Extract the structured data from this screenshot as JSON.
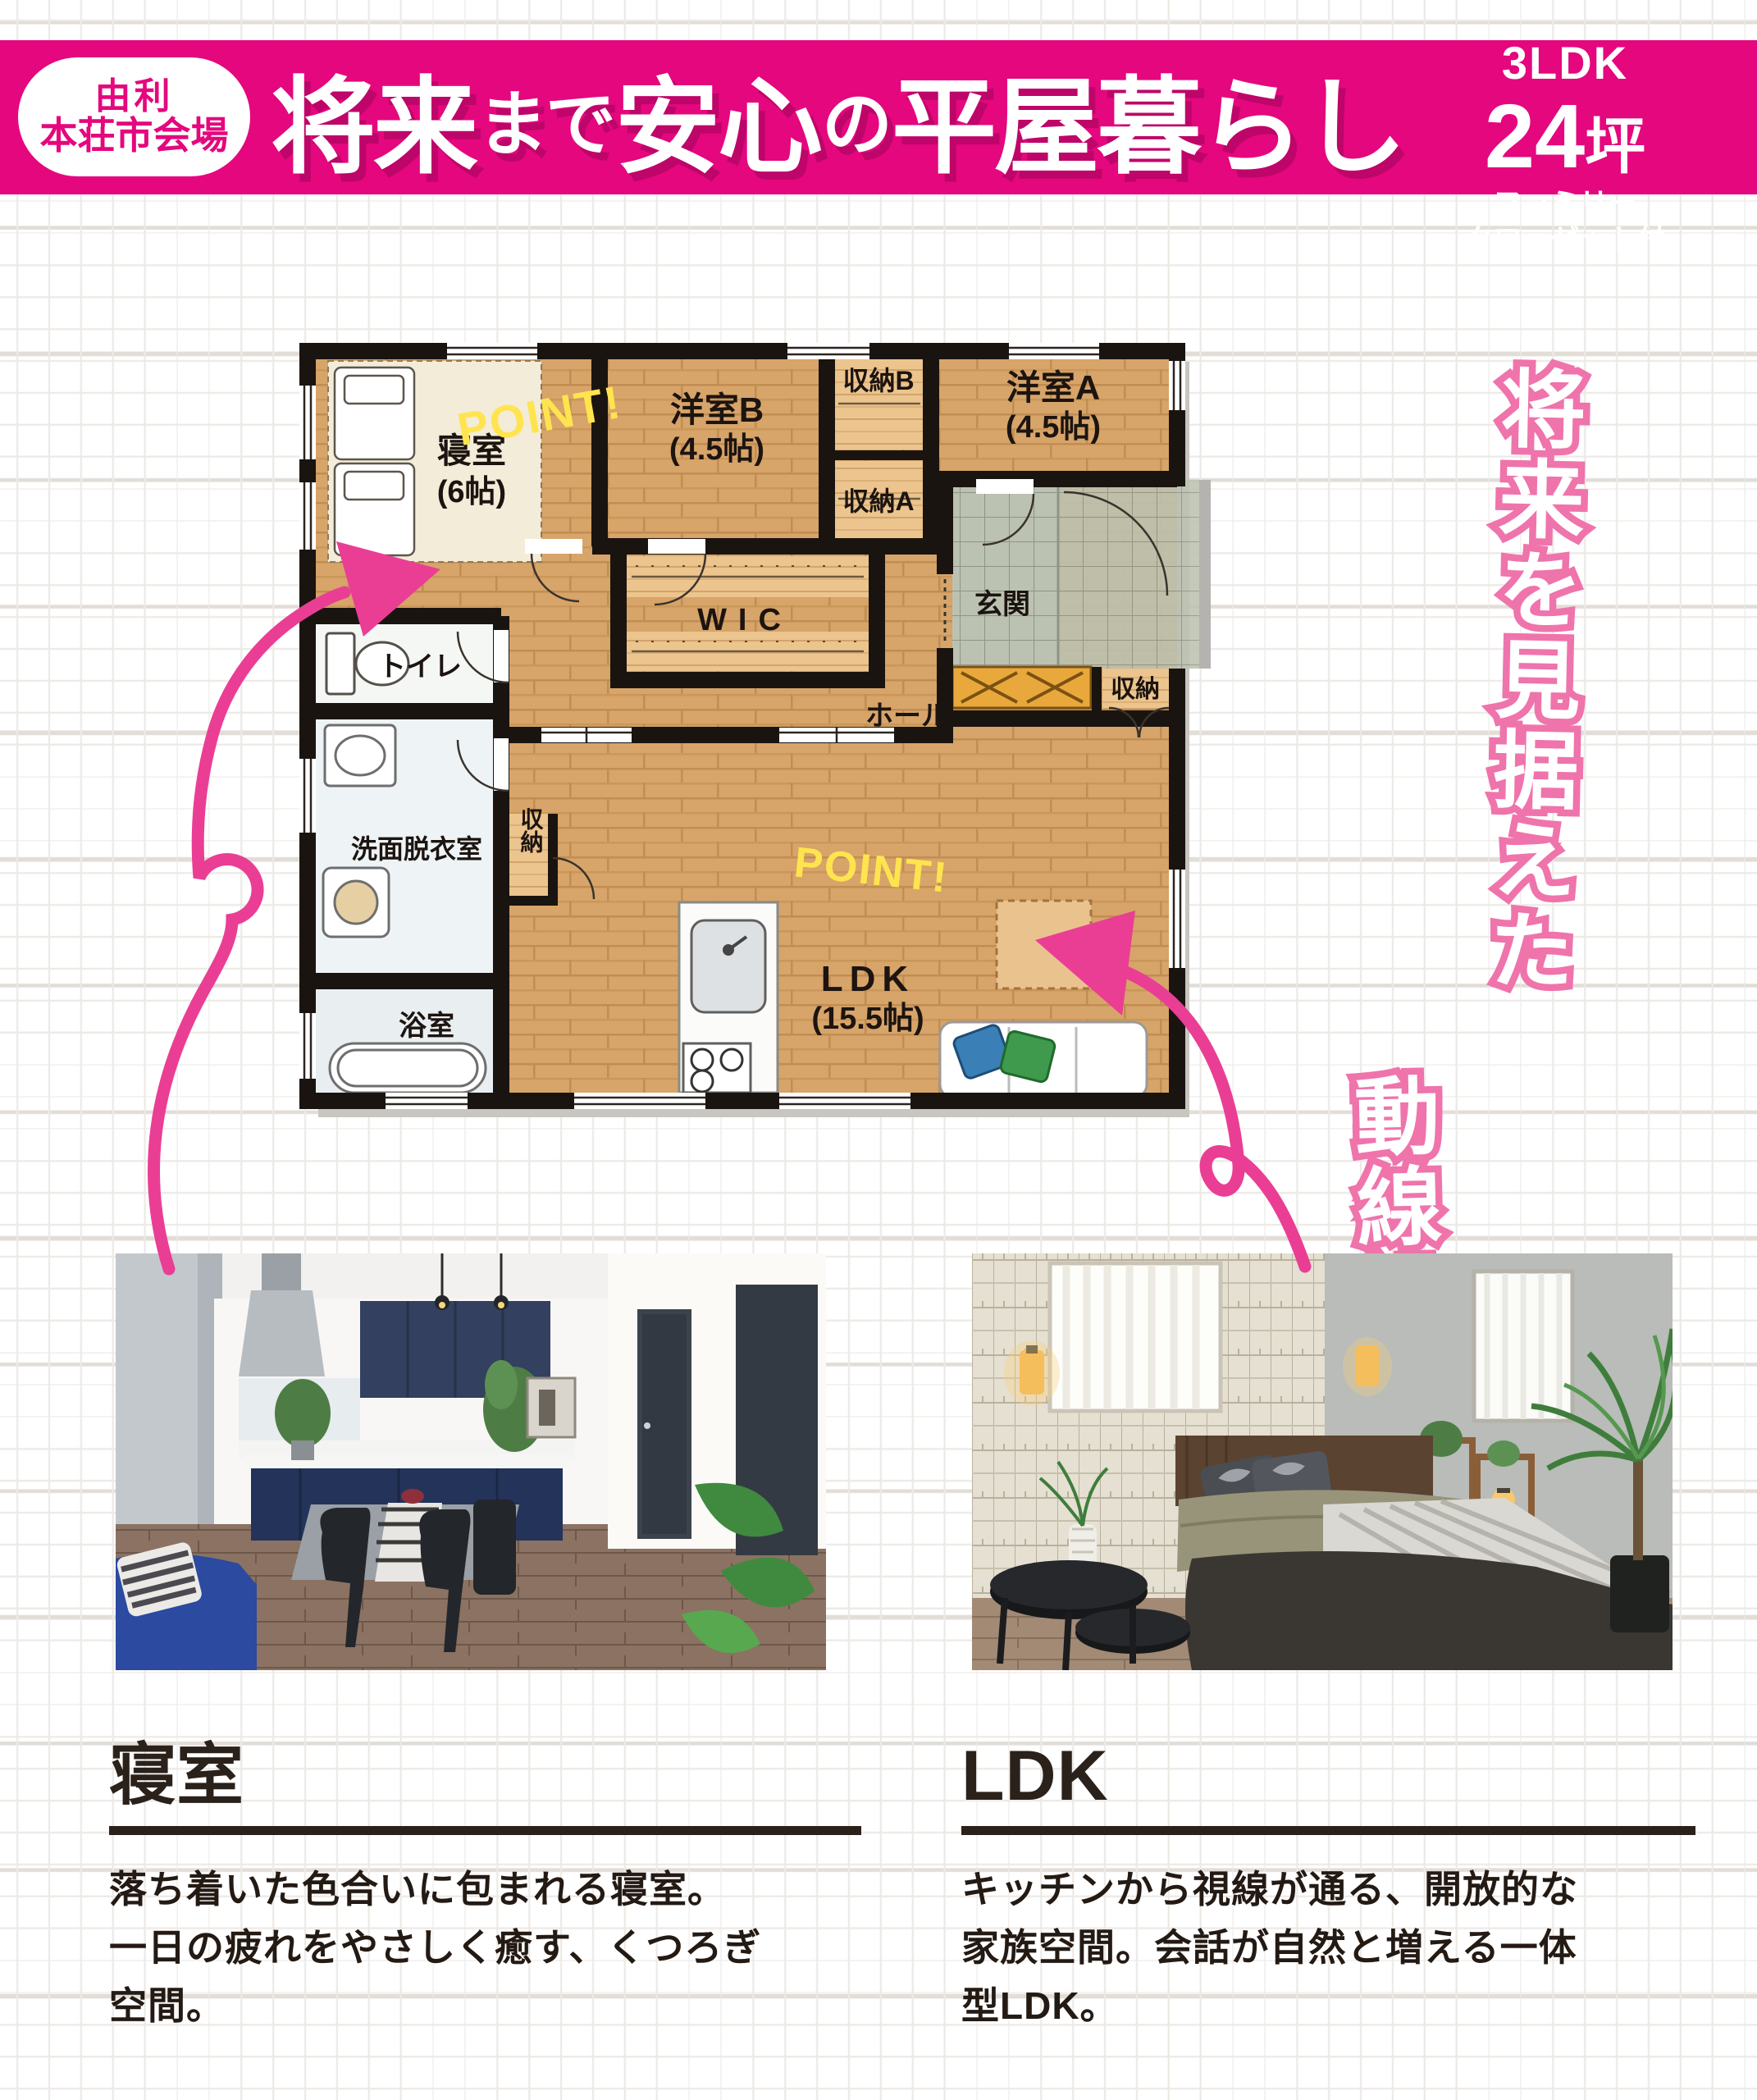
{
  "header": {
    "venue_badge": {
      "line1": "由利",
      "line2": "本荘市会場"
    },
    "title_parts": [
      {
        "text": "将来",
        "size": "big"
      },
      {
        "text": "まで",
        "size": "small"
      },
      {
        "text": "安心",
        "size": "big"
      },
      {
        "text": "の",
        "size": "small"
      },
      {
        "text": "平屋暮らし",
        "size": "big"
      }
    ],
    "seal": {
      "line1": "3LDK",
      "num": "24",
      "unit": "坪",
      "sub1": "ファミリー",
      "sub2": "クローゼット付",
      "color": "#29b2e2"
    },
    "band_color": "#e4077e"
  },
  "tagline": {
    "col1": "将来を見据えた",
    "col2": "動線設計。"
  },
  "floorplan": {
    "point_label": "POINT!",
    "rooms": {
      "bedroom_name": "寝室",
      "bedroom_size": "(6帖)",
      "yoshitsu_b_name": "洋室B",
      "yoshitsu_b_size": "(4.5帖)",
      "yoshitsu_a_name": "洋室A",
      "yoshitsu_a_size": "(4.5帖)",
      "ldk_name": "LDK",
      "ldk_size": "(15.5帖)",
      "wic": "WIC",
      "hall": "ホール",
      "genkan": "玄関",
      "toilet": "トイレ",
      "senmen": "洗面脱衣室",
      "bath": "浴室",
      "shuno_b": "収納B",
      "shuno_a": "収納A",
      "shuno_small": "収納",
      "shuno_ldk": "収納"
    }
  },
  "captions": {
    "left": {
      "title": "寝室",
      "lines": [
        "落ち着いた色合いに包まれる寝室。",
        "一日の疲れをやさしく癒す、くつろぎ",
        "空間。"
      ]
    },
    "right": {
      "title": "LDK",
      "lines": [
        "キッチンから視線が通る、開放的な",
        "家族空間。会話が自然と増える一体",
        "型LDK。"
      ]
    }
  }
}
